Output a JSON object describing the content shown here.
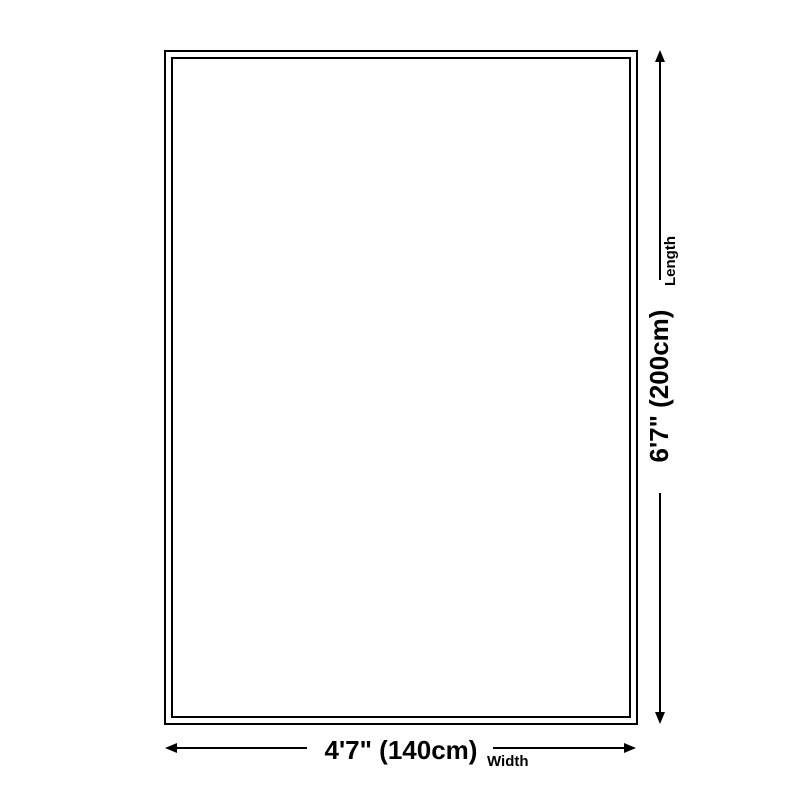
{
  "diagram": {
    "type": "product-size-diagram",
    "background_color": "#ffffff",
    "line_color": "#000000",
    "length": {
      "value": "6'7\" (200cm)",
      "label": "Length"
    },
    "width": {
      "value": "4'7\" (140cm)",
      "label": "Width"
    }
  }
}
